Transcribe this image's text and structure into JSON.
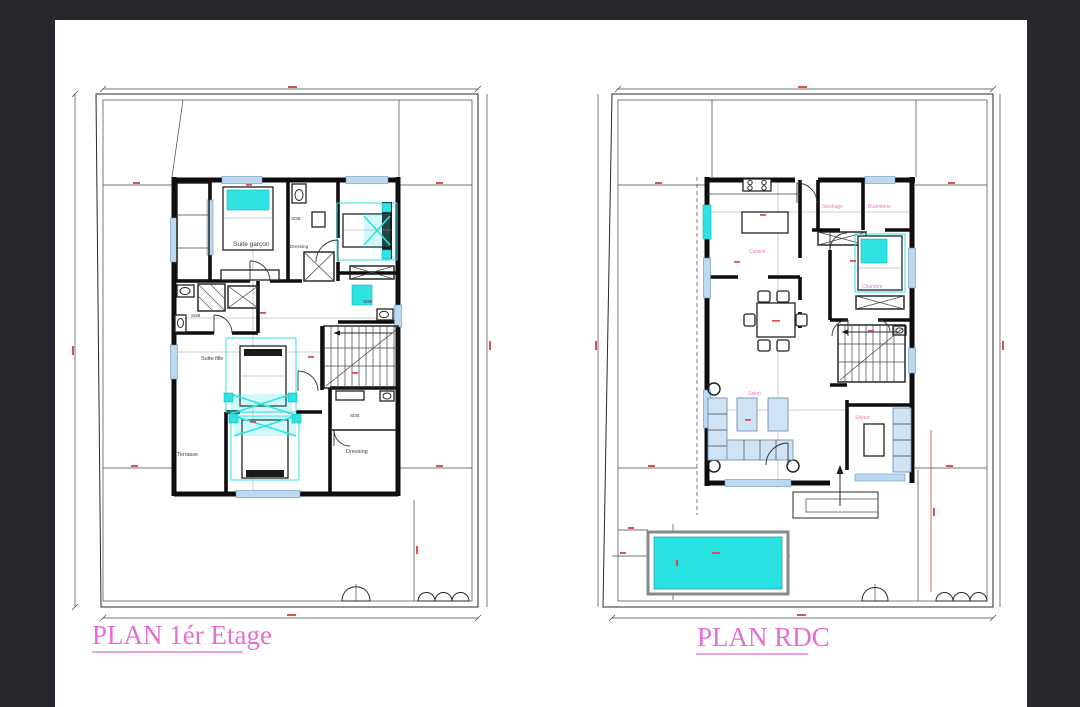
{
  "sheet": {
    "type": "architectural-floor-plans",
    "paper_color": "#ffffff",
    "frame_color": "#27272e"
  },
  "titles": {
    "etage": "PLAN 1ér Etage",
    "rdc": "PLAN RDC"
  },
  "etage_rooms": {
    "suite_garcon": "Suite garçon",
    "sdb_top": "SDB",
    "dressing_mid": "Dressing",
    "sdb_left": "SDB",
    "sdb_right": "SDB",
    "suite_fille": "Suite fille",
    "terrasse": "Terrasse",
    "sdb_bottom": "SDB",
    "dressing_bottom": "Dressing"
  },
  "rdc_rooms": {
    "cuisine": "Cuisine",
    "stockage": "Stockage",
    "buanderie": "Buanderie",
    "chambre": "Chambre",
    "salon": "Salon",
    "sejour": "Séjour"
  },
  "colors": {
    "walls": "#0e0e10",
    "dimension_red": "#d9504f",
    "window_blue": "#bcd9f2",
    "fixture_cyan": "#2fe3e3",
    "pool_cyan": "#28e2e2",
    "room_label_pink": "#e879c9",
    "title_pink": "#e46ed3"
  }
}
